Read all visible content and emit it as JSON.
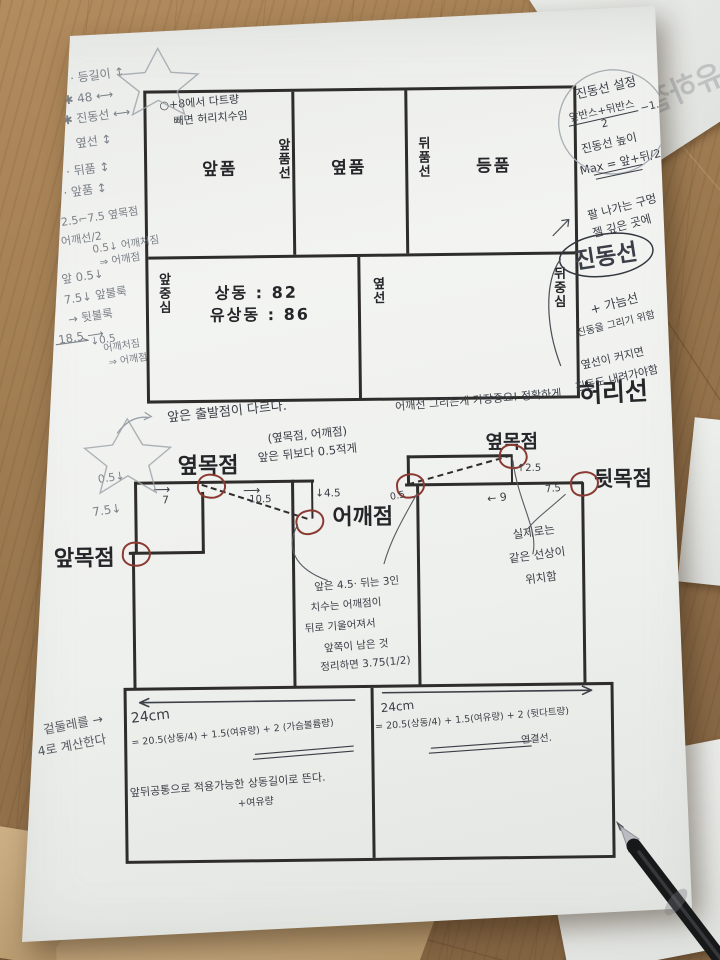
{
  "palette": {
    "red_pencil": "#8a3a31",
    "pen_ink": "#3a3e46",
    "pencil": "#7b8088",
    "paper": "#eff1ee",
    "desk_wood": "#96744c"
  },
  "background": {
    "ghost_text": "유하철"
  },
  "top_diagram": {
    "note_line1": "○+8에서 다트량",
    "note_line2": "빼면 허리치수임",
    "panels": [
      "앞품",
      "옆품",
      "등품"
    ],
    "seams": [
      "앞품선",
      "뒤품선"
    ],
    "front_center": "앞중심",
    "side": "옆선",
    "back_center": "뒤중심",
    "bust": "상동 : 82",
    "bust_ease": "유상동 : 86",
    "waist": "허리선"
  },
  "left_margin": {
    "notes": [
      "· 등길이 ↕",
      "✱ 48 ⟷",
      "✱ 진동선 ⟷",
      "옆선 ↕",
      "· 뒤품 ↕",
      "· 앞품 ↕",
      "2.5⌐7.5 옆목점",
      "어깨선/2",
      "0.5↓ 어깨처짐",
      "⇒ 어깨점",
      "앞 0.5↓",
      "7.5↓ 앞불룩",
      "→ 뒷불룩",
      "18.5 ⟶",
      "↓0.5",
      "어깨처짐",
      "⇒ 어깨점"
    ],
    "girth_note1": "겉둘레를 →",
    "girth_note2": "4로 계산한다"
  },
  "right_margin": {
    "armhole_setting": "진동선 설정",
    "frac_top": "앞반스+뒤반스",
    "frac_bottom": "2",
    "minus": "−1.5",
    "armhole_height": "진동선 높이",
    "max_formula": "Max = 앞+뒤/2",
    "arm_hole1": "팔 나가는 구멍",
    "arm_hole2": "젤 깊은 곳에",
    "armhole_line": "진동선",
    "gauge": "+ 가늠선",
    "draw_note": "진동을 그리기 위함",
    "side_note1": "옆선이 커지면",
    "side_note2": "진동도 내려가야함"
  },
  "mid_notes": {
    "start": "앞은 출발점이 다르다.",
    "important": "어깨선 그리는게 가장중요! 정확하게",
    "points_pair": "(옆목점, 어깨점)",
    "front_less": "앞은 뒤보다 0.5적게"
  },
  "lower_diagram": {
    "side_neck_front": "옆목점",
    "shoulder": "어깨점",
    "front_neck": "앞목점",
    "side_neck_back": "옆목점",
    "back_neck": "뒷목점",
    "dims": {
      "arr": "⟶",
      "w7": "7",
      "w105": "10.5",
      "d45": "↓4.5",
      "d05": "0.5↓",
      "d75": "7.5↓",
      "b05": "0.5",
      "b25": "↑2.5",
      "b9": "← 9",
      "b75": "7.5"
    },
    "reason_note": [
      "앞은 4.5· 뒤는 3인",
      "치수는 어깨점이",
      "뒤로 기울어져서",
      "앞쪽이 남은 것",
      "정리하면 3.75(1/2)"
    ],
    "same_line": [
      "실제로는",
      "같은 선상이",
      "위치함"
    ]
  },
  "bottom_band": {
    "left_width": "24cm",
    "left_formula": "= 20.5(상동/4) + 1.5(여유량) + 2 (가슴볼륨량)",
    "right_width": "24cm",
    "right_formula": "= 20.5(상동/4) + 1.5(여유량) + 2 (뒷다트량)",
    "right_sub": "연결선.",
    "common_note": "앞뒤공통으로 적용가능한 상동길이로 뜬다.",
    "plus_ease": "+여유량"
  }
}
